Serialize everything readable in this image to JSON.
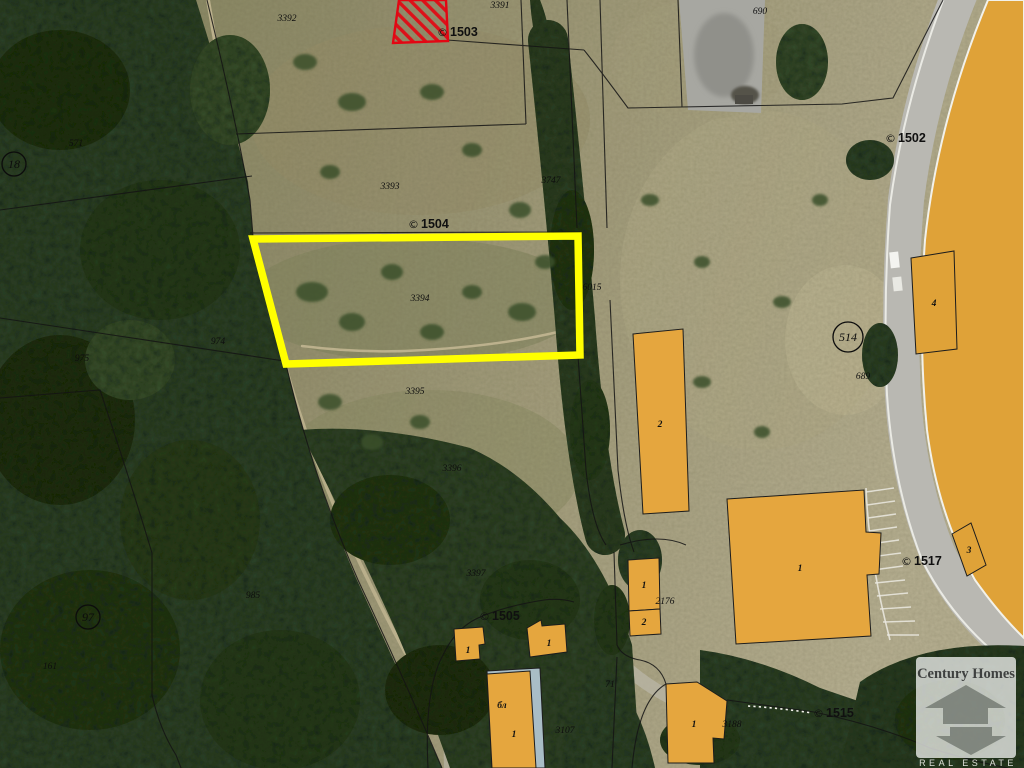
{
  "logo": {
    "title": "Century Homes",
    "subtitle": "REAL ESTATE"
  },
  "colors": {
    "highlight_parcel": "#ffff00",
    "building_fill": "#e5a63e",
    "stadium_fill": "#dfa238",
    "restricted_hatch": "#e30613",
    "boundary_line": "#141414"
  },
  "highlight_parcel": {
    "label": "3394"
  },
  "parcel_labels": [
    {
      "t": "3391",
      "x": 500,
      "y": 8
    },
    {
      "t": "3392",
      "x": 287,
      "y": 21
    },
    {
      "t": "3393",
      "x": 390,
      "y": 189
    },
    {
      "t": "3394",
      "x": 420,
      "y": 301
    },
    {
      "t": "3395",
      "x": 415,
      "y": 394
    },
    {
      "t": "3396",
      "x": 452,
      "y": 471
    },
    {
      "t": "3397",
      "x": 476,
      "y": 576
    },
    {
      "t": "3747",
      "x": 551,
      "y": 183
    },
    {
      "t": "6015",
      "x": 592,
      "y": 290
    },
    {
      "t": "690",
      "x": 760,
      "y": 14
    },
    {
      "t": "689",
      "x": 863,
      "y": 379
    },
    {
      "t": "2176",
      "x": 665,
      "y": 604
    },
    {
      "t": "71",
      "x": 610,
      "y": 687
    },
    {
      "t": "3188",
      "x": 732,
      "y": 727
    },
    {
      "t": "3107",
      "x": 565,
      "y": 733
    },
    {
      "t": "571",
      "x": 76,
      "y": 146
    },
    {
      "t": "974",
      "x": 218,
      "y": 344
    },
    {
      "t": "975",
      "x": 82,
      "y": 361
    },
    {
      "t": "161",
      "x": 50,
      "y": 669
    },
    {
      "t": "985",
      "x": 253,
      "y": 598
    }
  ],
  "point_labels": [
    {
      "icon": "©",
      "t": "1503",
      "x": 450,
      "y": 36
    },
    {
      "icon": "©",
      "t": "1504",
      "x": 421,
      "y": 228
    },
    {
      "icon": "©",
      "t": "1502",
      "x": 898,
      "y": 142
    },
    {
      "icon": "©",
      "t": "1505",
      "x": 492,
      "y": 620
    },
    {
      "icon": "©",
      "t": "1515",
      "x": 826,
      "y": 717
    },
    {
      "icon": "©",
      "t": "1517",
      "x": 914,
      "y": 565
    }
  ],
  "circled_labels": [
    {
      "t": "18",
      "x": 14,
      "y": 168,
      "r": 12
    },
    {
      "t": "514",
      "x": 848,
      "y": 341,
      "r": 15
    },
    {
      "t": "97",
      "x": 88,
      "y": 621,
      "r": 12
    }
  ],
  "building_labels": [
    {
      "t": "2",
      "x": 660,
      "y": 427
    },
    {
      "t": "1",
      "x": 800,
      "y": 571
    },
    {
      "t": "1",
      "x": 644,
      "y": 588
    },
    {
      "t": "2",
      "x": 644,
      "y": 625
    },
    {
      "t": "4",
      "x": 934,
      "y": 306
    },
    {
      "t": "3",
      "x": 969,
      "y": 553
    },
    {
      "t": "1",
      "x": 468,
      "y": 653
    },
    {
      "t": "1",
      "x": 549,
      "y": 646
    },
    {
      "t": "бл",
      "x": 502,
      "y": 708
    },
    {
      "t": "1",
      "x": 514,
      "y": 737
    },
    {
      "t": "1",
      "x": 694,
      "y": 727
    }
  ]
}
